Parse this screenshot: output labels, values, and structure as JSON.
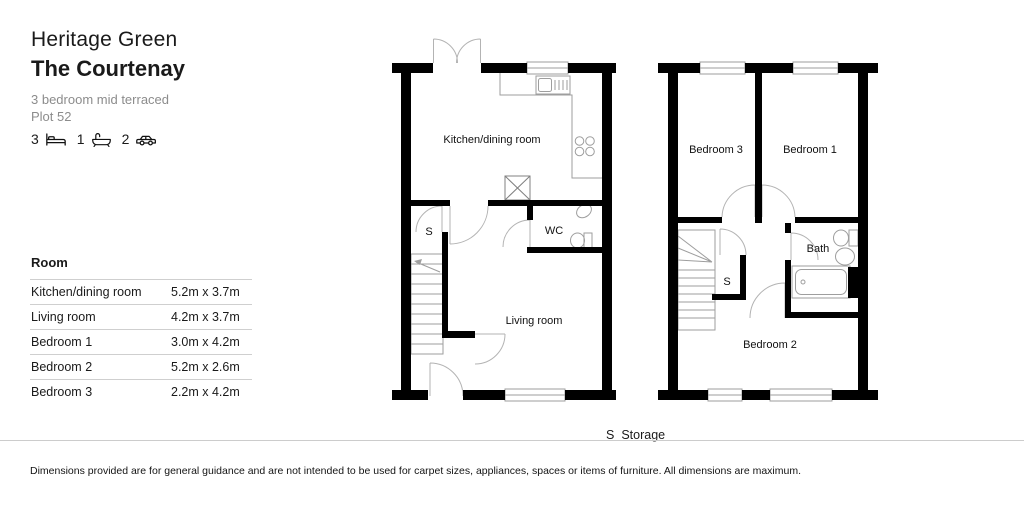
{
  "header": {
    "development": "Heritage Green",
    "house_name": "The Courtenay",
    "description": "3 bedroom mid terraced",
    "plot": "Plot 52",
    "stats": [
      {
        "count": "3",
        "icon": "bed-icon"
      },
      {
        "count": "1",
        "icon": "bath-icon"
      },
      {
        "count": "2",
        "icon": "car-icon"
      }
    ]
  },
  "room_table": {
    "header": "Room",
    "rows": [
      {
        "room": "Kitchen/dining room",
        "dimensions": "5.2m x 3.7m"
      },
      {
        "room": "Living room",
        "dimensions": "4.2m x 3.7m"
      },
      {
        "room": "Bedroom 1",
        "dimensions": "3.0m x 4.2m"
      },
      {
        "room": "Bedroom 2",
        "dimensions": "5.2m x 2.6m"
      },
      {
        "room": "Bedroom 3",
        "dimensions": "2.2m x 4.2m"
      }
    ]
  },
  "floorplans": {
    "ground_floor": {
      "labels": {
        "kitchen": "Kitchen/dining room",
        "storage": "S",
        "wc": "WC",
        "living": "Living room"
      }
    },
    "first_floor": {
      "labels": {
        "bedroom3": "Bedroom 3",
        "bedroom1": "Bedroom 1",
        "bath": "Bath",
        "storage": "S",
        "bedroom2": "Bedroom 2"
      }
    }
  },
  "legend": {
    "symbol": "S",
    "label": "Storage"
  },
  "footer": {
    "disclaimer": "Dimensions provided are for general guidance and are not intended to be used for carpet sizes, appliances, spaces or items of furniture. All dimensions are maximum."
  },
  "colors": {
    "wall": "#000000",
    "fixture_line": "#9e9e9e",
    "door_line": "#b3b3b3",
    "muted_text": "#8c8c8c",
    "divider": "#cccccc"
  }
}
